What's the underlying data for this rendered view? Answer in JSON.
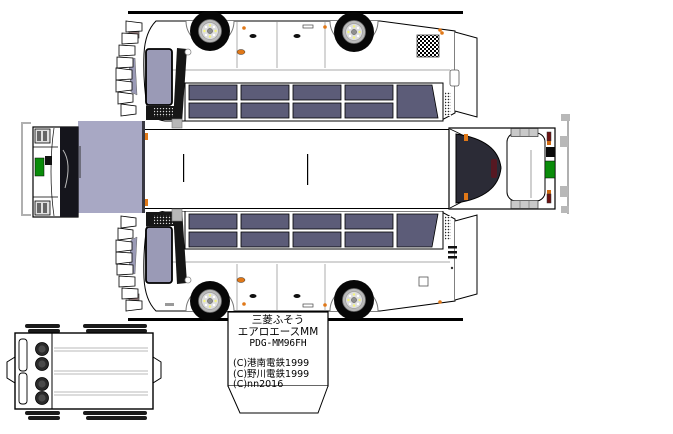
{
  "info_box": {
    "maker": "三菱ふそう",
    "model": "エアロエースMM",
    "code": "PDG-MM96FH",
    "credits": [
      "(C)港南電鉄1999",
      "(C)野川電鉄1999",
      "(C)nn2016"
    ]
  },
  "colors": {
    "background": "#ffffff",
    "outline": "#000000",
    "window_glass": "#5c5c78",
    "door_glass": "#9a9ab6",
    "roof_front_lavender": "#a8a8c4",
    "destination_sign_green": "#0a8c0a",
    "marker_light_orange": "#e07818",
    "rear_window_dark": "#2b2b36",
    "tail_light_red": "#6b1212",
    "guide_gray": "#b0b0b0"
  }
}
